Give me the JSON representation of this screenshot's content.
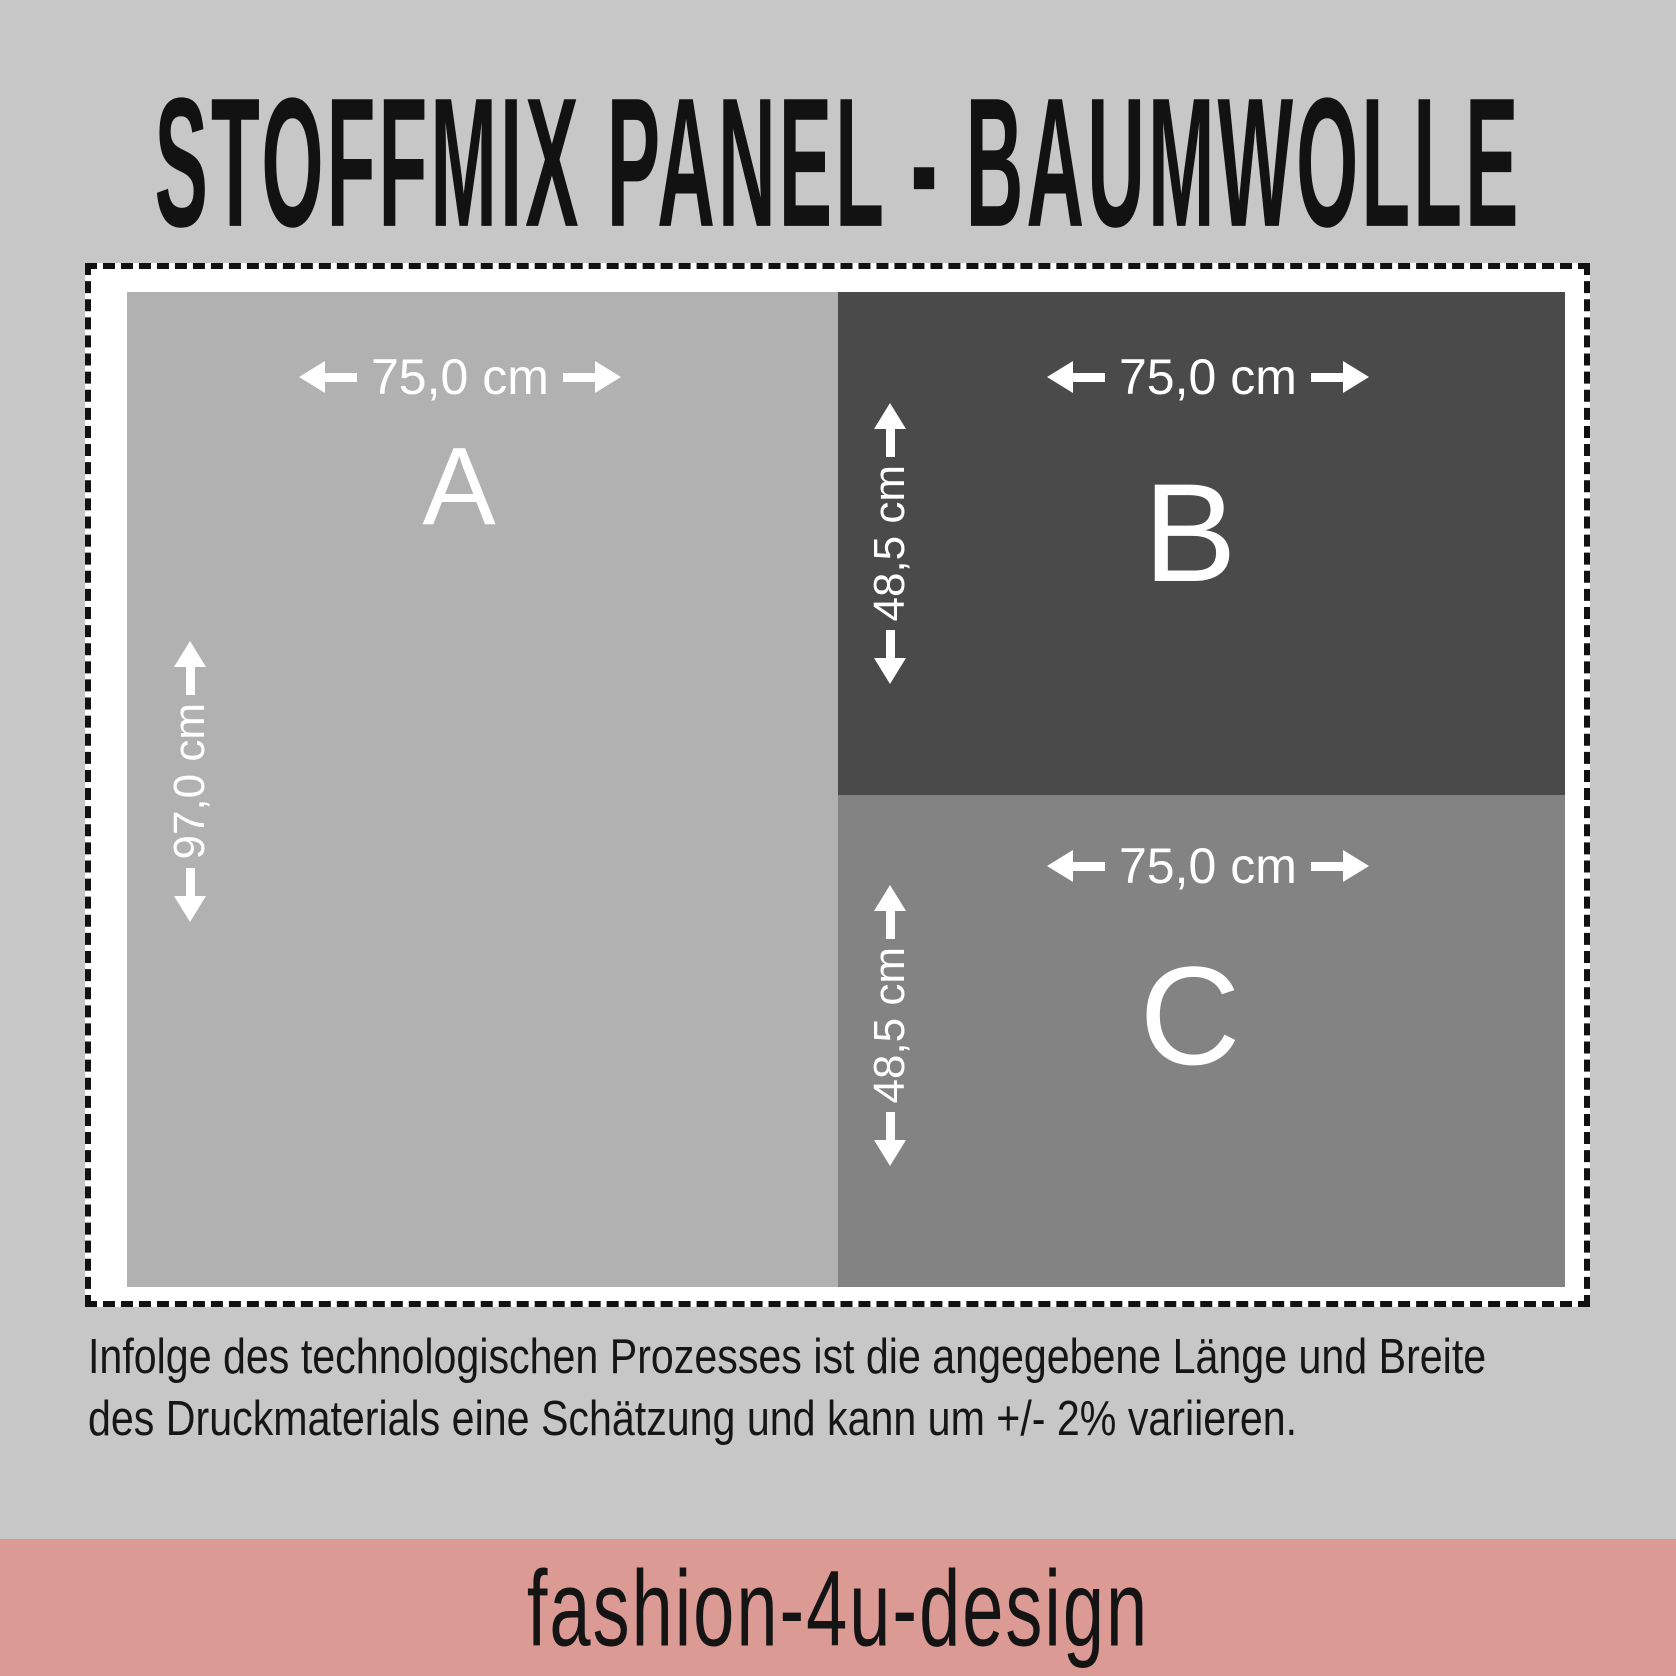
{
  "title": "STOFFMIX PANEL - BAUMWOLLE",
  "panels": [
    {
      "id": "A",
      "label": "A",
      "width_label": "75,0 cm",
      "height_label": "97,0 cm",
      "color": "#b1b1b1"
    },
    {
      "id": "B",
      "label": "B",
      "width_label": "75,0 cm",
      "height_label": "48,5 cm",
      "color": "#4a4a4a"
    },
    {
      "id": "C",
      "label": "C",
      "width_label": "75,0 cm",
      "height_label": "48,5 cm",
      "color": "#838383"
    }
  ],
  "side_strip": {
    "product_info": "STOFFMIX-PANEL für Schultüten & Accessoires 97 cm x 150 cm | www.fashion-4u-design.de & www.deine-schultuete.de",
    "wash_label": "Waschempfehlung",
    "care_icons": [
      "hand-wash-icon",
      "wash-30-icon",
      "no-tumble-dry-icon",
      "no-bleach-icon",
      "iron-icon"
    ],
    "microtext_group1": [
      "Material: 100 % Baumwolle",
      "Bedruckt mit zertifizierten Textilfarben",
      "Für Schultüten, Kissen & Accessoires geeignet"
    ],
    "microtext_group2": [
      "Bei 30 °C im Schonwaschgang waschen",
      "Nicht bleichen, nicht im Trockner trocknen",
      "Auf links bügeln, bei mittlerer Temperatur",
      "Farben können nach dem Waschen leicht abweichen"
    ]
  },
  "disclaimer": {
    "line1": "Infolge des technologischen Prozesses ist die angegebene Länge und Breite",
    "line2": "des Druckmaterials eine Schätzung und kann um +/- 2% variieren."
  },
  "footer": {
    "brand": "fashion-4u-design"
  },
  "colors": {
    "page_background": "#c7c7c7",
    "cut_box_background": "#ffffff",
    "dashed_border": "#111111",
    "panel_a": "#b1b1b1",
    "panel_b": "#4a4a4a",
    "panel_c": "#838383",
    "dimension_text": "#ffffff",
    "footer_bar": "#dc9a94",
    "cutline_accent": "#9b5147"
  }
}
